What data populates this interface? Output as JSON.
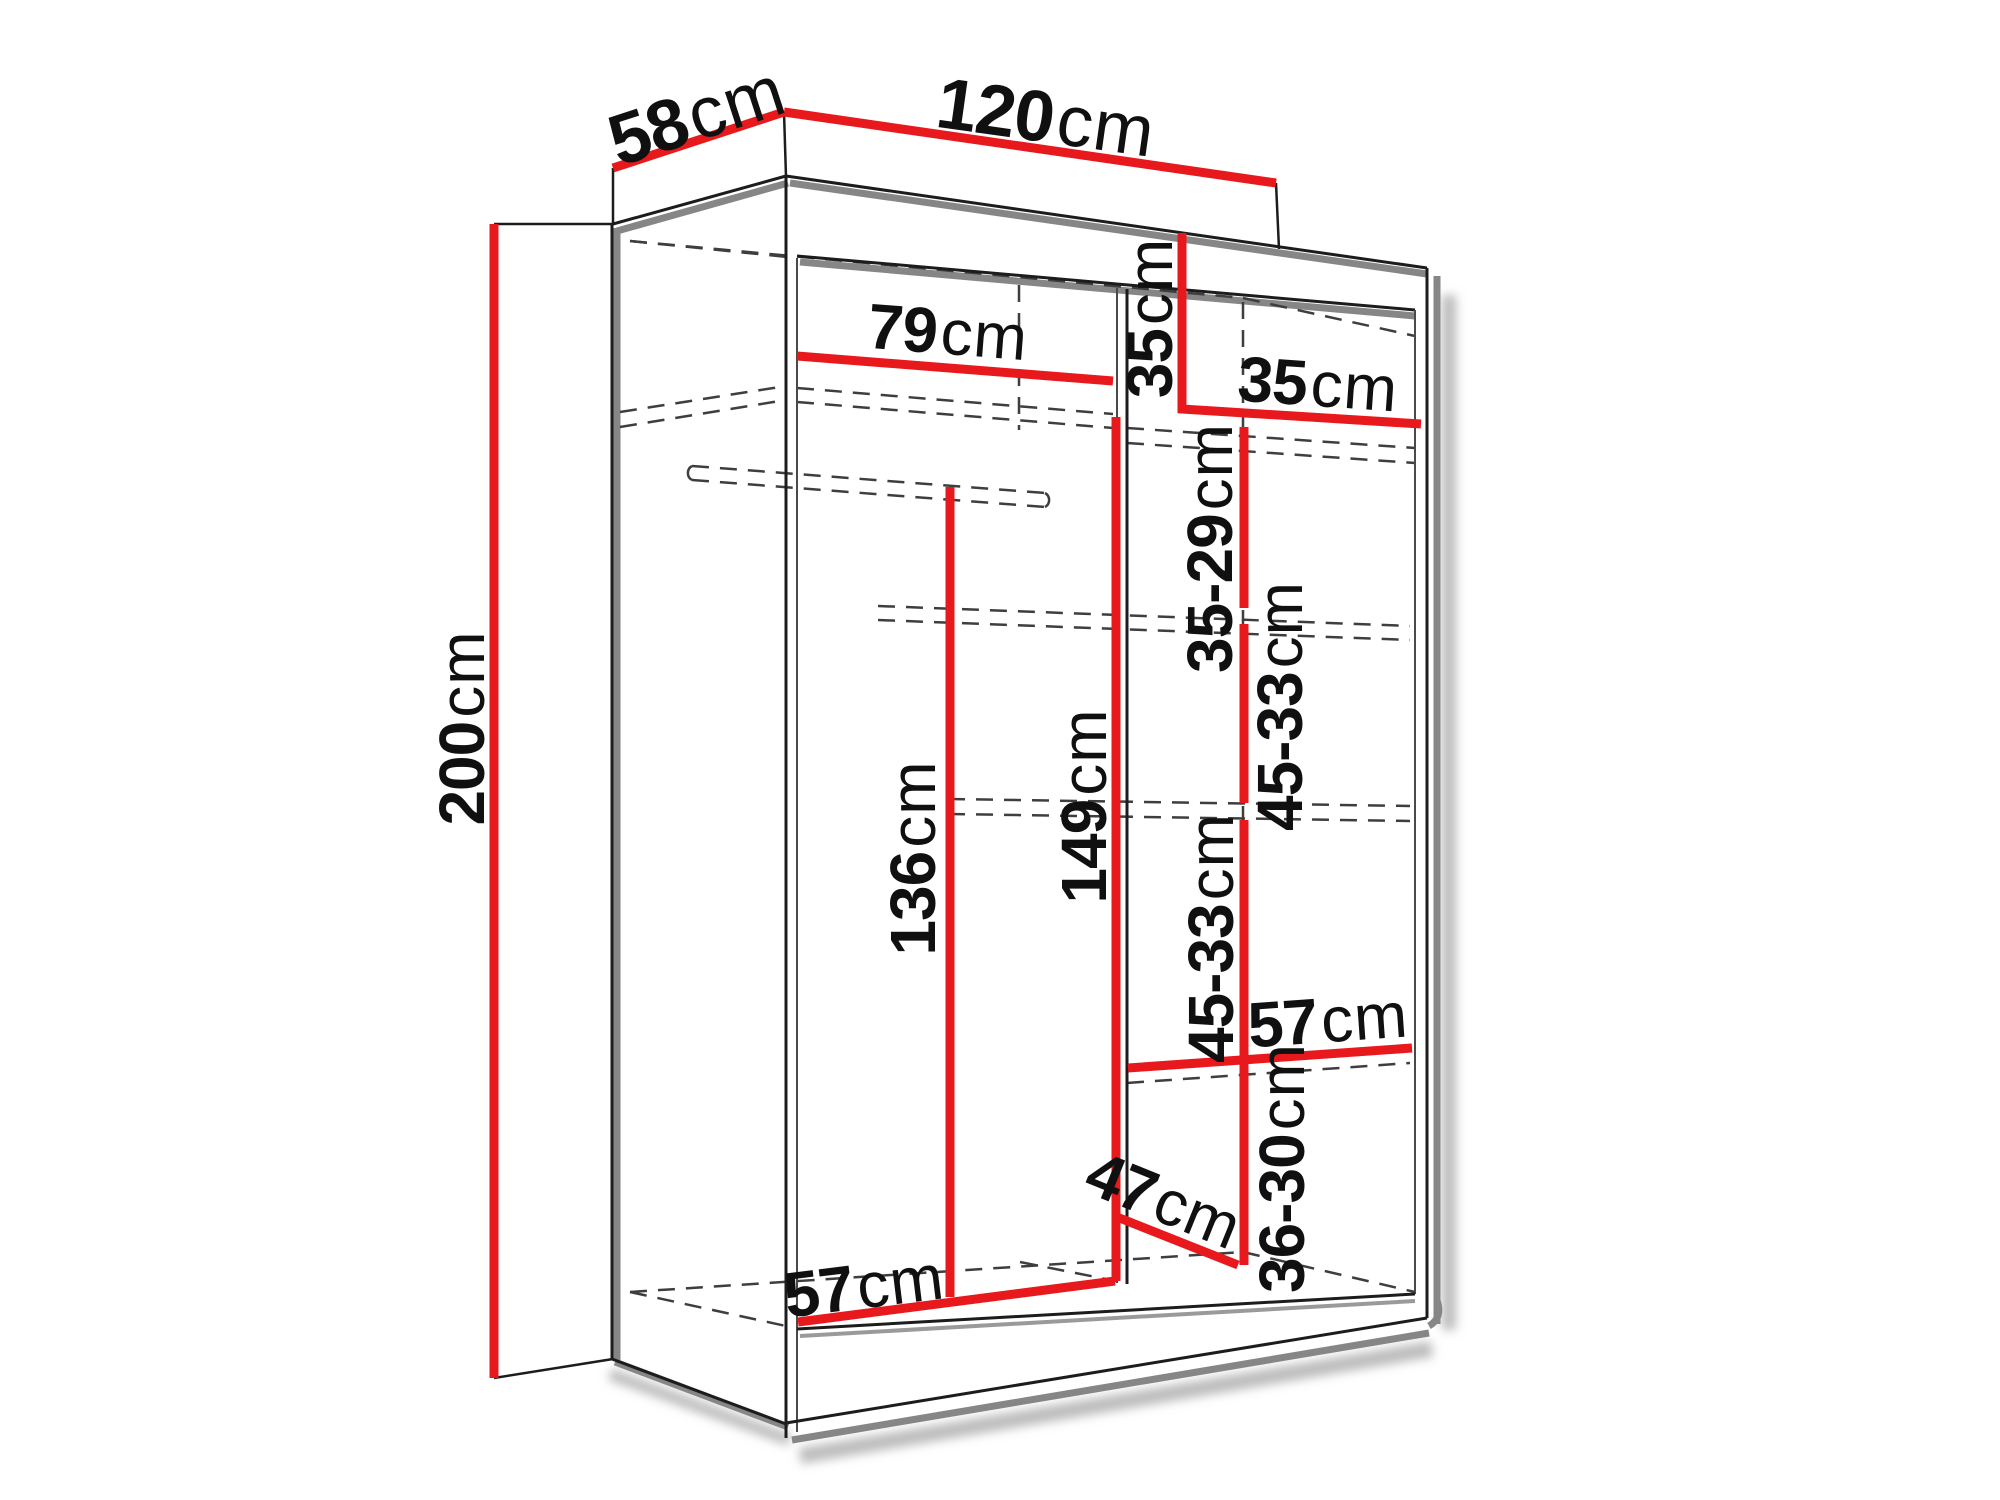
{
  "diagram": {
    "type": "furniture-dimension-diagram",
    "subject": "two-door wardrobe with interior shelving, perspective wireframe view",
    "unit": "cm",
    "labels": {
      "depth": {
        "value": "58",
        "unit": "cm"
      },
      "width": {
        "value": "120",
        "unit": "cm"
      },
      "height": {
        "value": "200",
        "unit": "cm"
      },
      "left_section_width": {
        "value": "79",
        "unit": "cm"
      },
      "top_compartment_height": {
        "value": "35",
        "unit": "cm"
      },
      "right_section_width": {
        "value": "35",
        "unit": "cm"
      },
      "right_gap_1": {
        "value": "35-29",
        "unit": "cm"
      },
      "right_gap_2": {
        "value": "45-33",
        "unit": "cm"
      },
      "right_gap_3": {
        "value": "45-33",
        "unit": "cm"
      },
      "right_gap_4": {
        "value": "36-30",
        "unit": "cm"
      },
      "rail_to_floor_height": {
        "value": "136",
        "unit": "cm"
      },
      "divider_height": {
        "value": "149",
        "unit": "cm"
      },
      "right_shelf_width": {
        "value": "57",
        "unit": "cm"
      },
      "left_bottom_width": {
        "value": "57",
        "unit": "cm"
      },
      "bottom_shelf_depth": {
        "value": "47",
        "unit": "cm"
      }
    },
    "colors": {
      "dimension_line": "#e8191c",
      "outline": "#1c1c1c",
      "shadow": "#868686",
      "hidden_edge": "#3e3e3e",
      "text": "#101010",
      "background": "#ffffff"
    }
  }
}
